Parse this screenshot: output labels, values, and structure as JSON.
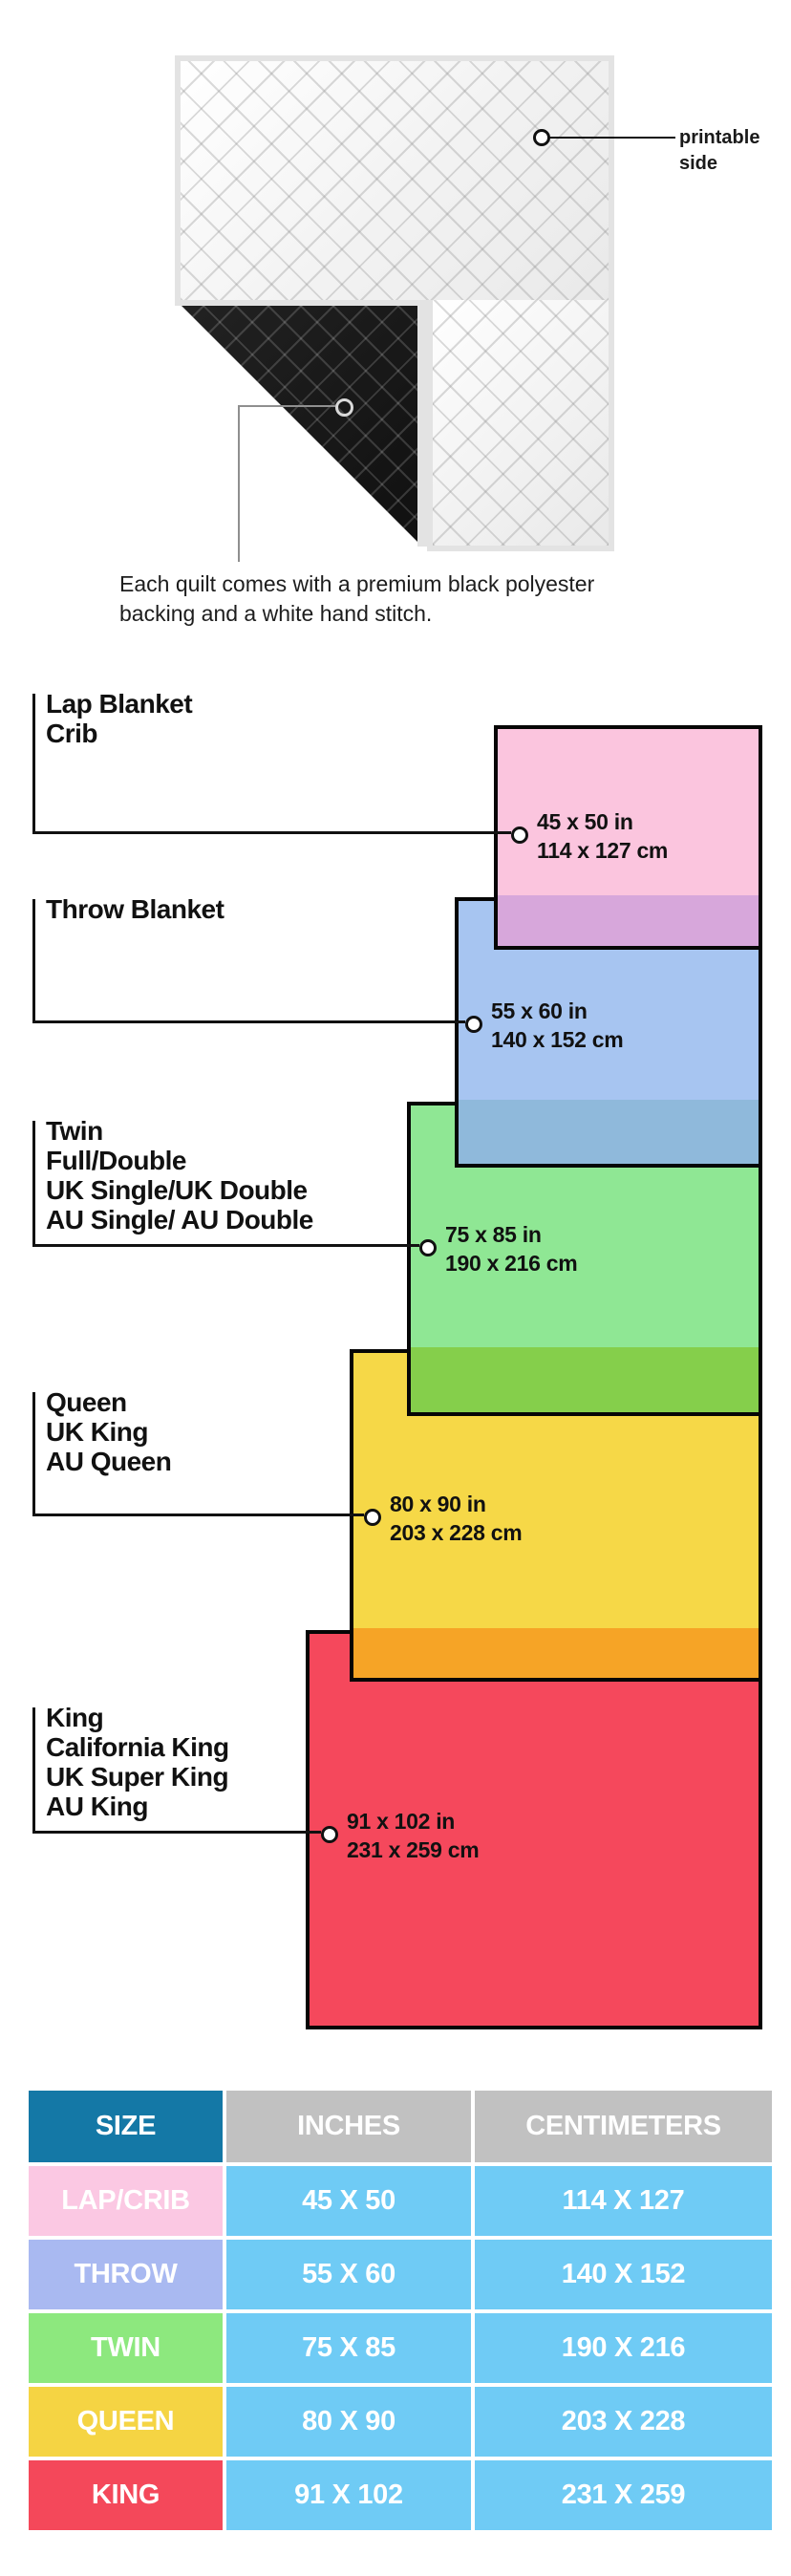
{
  "hero": {
    "printable_line1": "printable",
    "printable_line2": "side",
    "caption_line1": "Each quilt comes with a premium black polyester",
    "caption_line2": "backing and a white hand stitch."
  },
  "sizes": [
    {
      "label_lines": [
        "Lap Blanket",
        "Crib"
      ],
      "inches": "45 x 50 in",
      "cm": "114 x 127 cm",
      "fill": "#FBC5DE",
      "overlap": "#D7A7DB"
    },
    {
      "label_lines": [
        "Throw Blanket"
      ],
      "inches": "55 x 60 in",
      "cm": "140 x 152 cm",
      "fill": "#A7C5F1",
      "overlap": "#8FB9DB"
    },
    {
      "label_lines": [
        "Twin",
        "Full/Double",
        "UK Single/UK Double",
        "AU Single/ AU Double"
      ],
      "inches": "75 x 85 in",
      "cm": "190 x 216 cm",
      "fill": "#8FE794",
      "overlap": "#85CF4B"
    },
    {
      "label_lines": [
        "Queen",
        "UK King",
        "AU Queen"
      ],
      "inches": "80 x 90 in",
      "cm": "203 x 228 cm",
      "fill": "#F6D847",
      "overlap": "#F6A426"
    },
    {
      "label_lines": [
        "King",
        "California King",
        "UK Super King",
        "AU King"
      ],
      "inches": "91 x 102 in",
      "cm": "231 x 259 cm",
      "fill": "#F5485C",
      "overlap": null
    }
  ],
  "table": {
    "headers": [
      "SIZE",
      "INCHES",
      "CENTIMETERS"
    ],
    "header_size_bg": "#1478A6",
    "header_gray_bg": "#C1C1C1",
    "data_cell_bg": "#6FCBF5",
    "rows": [
      {
        "size": "LAP/CRIB",
        "inches": "45 X 50",
        "cm": "114 X 127",
        "label_bg": "#FBC8E3"
      },
      {
        "size": "THROW",
        "inches": "55 X 60",
        "cm": "140 X 152",
        "label_bg": "#A9B9F1"
      },
      {
        "size": "TWIN",
        "inches": "75 X 85",
        "cm": "190 X 216",
        "label_bg": "#8DE87E"
      },
      {
        "size": "QUEEN",
        "inches": "80 X 90",
        "cm": "203 X 228",
        "label_bg": "#F5D443"
      },
      {
        "size": "KING",
        "inches": "91 X 102",
        "cm": "231 X 259",
        "label_bg": "#F4485A"
      }
    ]
  }
}
